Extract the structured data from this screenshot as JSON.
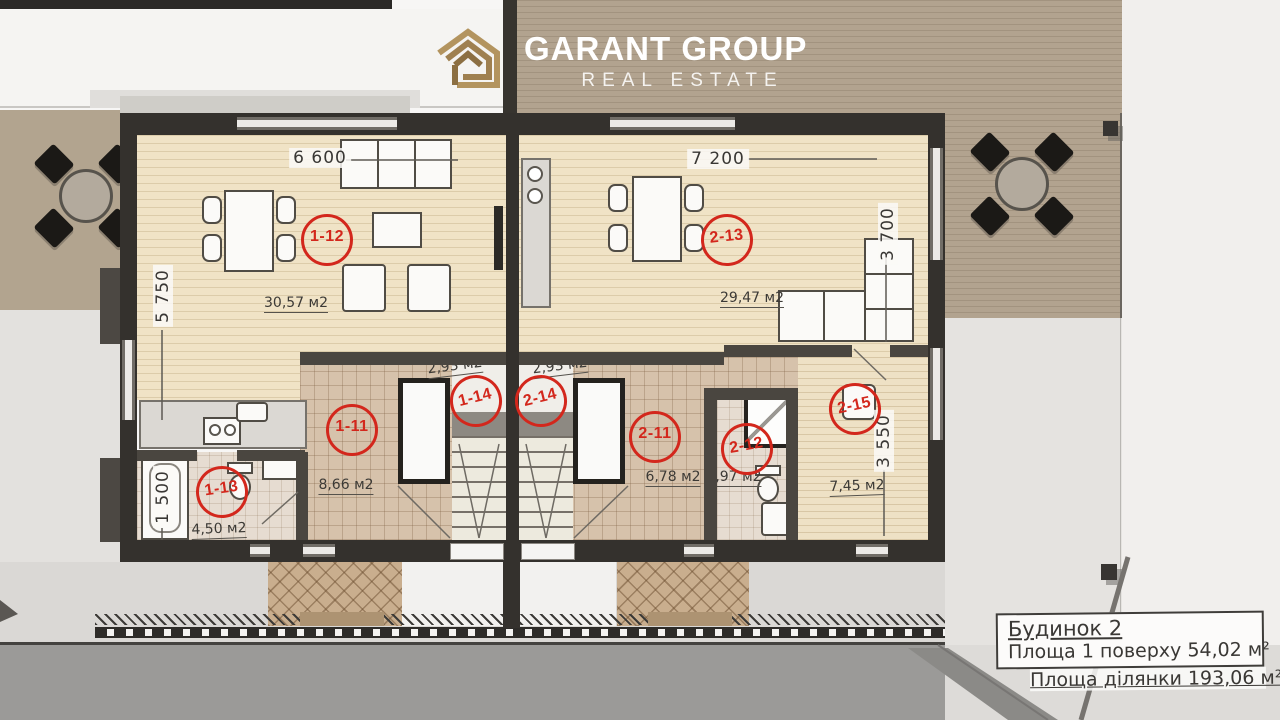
{
  "logo": {
    "name": "GARANT GROUP",
    "tagline": "REAL ESTATE"
  },
  "dimensions": {
    "left_unit_width": "6 600",
    "right_unit_width": "7 200",
    "left_unit_depth": "5 750",
    "left_bath_width": "1 500",
    "right_unit_depth": "3 700",
    "right_room_depth": "3 550"
  },
  "rooms": [
    {
      "label": "1-12",
      "area": "30,57 м2"
    },
    {
      "label": "2-13",
      "area": "29,47 м2"
    },
    {
      "label": "1-11",
      "area": "8,66 м2"
    },
    {
      "label": "1-13",
      "area": "4,50 м2"
    },
    {
      "label": "1-14",
      "area": "2,93 м2"
    },
    {
      "label": "2-14",
      "area": "2,93 м2"
    },
    {
      "label": "2-11",
      "area": "6,78 м2"
    },
    {
      "label": "2-12",
      "area": "1,97 м2"
    },
    {
      "label": "2-15",
      "area": "7,45 м2"
    }
  ],
  "info_box": {
    "building": "Будинок 2",
    "floor_area": "Площа 1 поверху 54,02 м²",
    "plot_area": "Площа ділянки 193,06 м²"
  },
  "colors": {
    "accent_red": "#d3271c",
    "logo_gold": "#a98a58",
    "wall_dark": "#34312d",
    "wood_floor": "#f0e3c6",
    "tile_floor": "#d6c2ab",
    "deck_tan": "#b2a38f",
    "road_gray": "#9b9a98"
  }
}
